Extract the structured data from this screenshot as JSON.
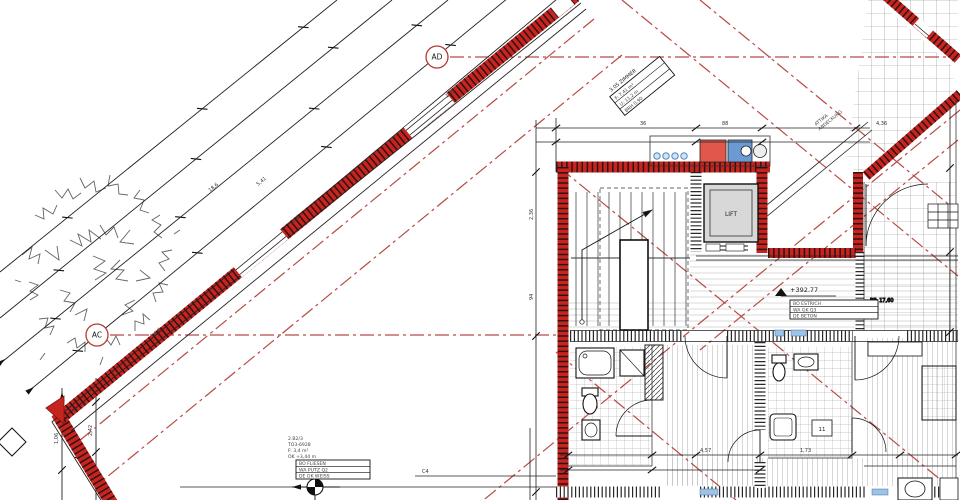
{
  "drawing": {
    "markers": {
      "ad": "AD",
      "ac": "AC"
    },
    "level_corridor": "+392.77",
    "lift": "LIFT",
    "room_top": {
      "l1": "3.05 ZIMMER",
      "l2": "F: 7,41 m²",
      "l3": "U: 11,2 m",
      "l4": "BRH 0,90"
    },
    "terrace_note": {
      "l1": "ATTIKA",
      "l2": "ABDECKUNG"
    },
    "corridor_label": {
      "r1": "BO  ESTRICH",
      "r2": "WA  GK Q3",
      "r3": "DE  BETON"
    },
    "room_bottom_label": {
      "l1": "2.B2/3",
      "l2": "TO3-6928",
      "l3": "F: 3,4 m²",
      "l4": "OK +3,44 m",
      "r1": "BO  FLIESEN",
      "r2": "WA  PUTZ Q2",
      "r3": "DE  GK WEISS"
    },
    "bf_note": "BF: 17,60",
    "shower_note": "11",
    "dims": {
      "w1": "3,64",
      "w2": "2,98",
      "w3": "1,25",
      "w4": "5,41",
      "w5": "18,6",
      "v1": "94",
      "v2": "2,36",
      "b1": "4,57",
      "b2": "1,73",
      "lv1": "1,06",
      "lv2": "2,42",
      "t1": "36",
      "t2": "88",
      "t3": "4,36",
      "c4": "C4"
    }
  },
  "colors": {
    "wall_red": "#c8241f",
    "axis_red": "#b84a44",
    "fixture_red": "#e2574c",
    "fixture_blue": "#6b9bd2",
    "glazing_blue": "#9dc3e6",
    "lift_gray": "#d8d8d8",
    "line": "#1c1c1c"
  }
}
